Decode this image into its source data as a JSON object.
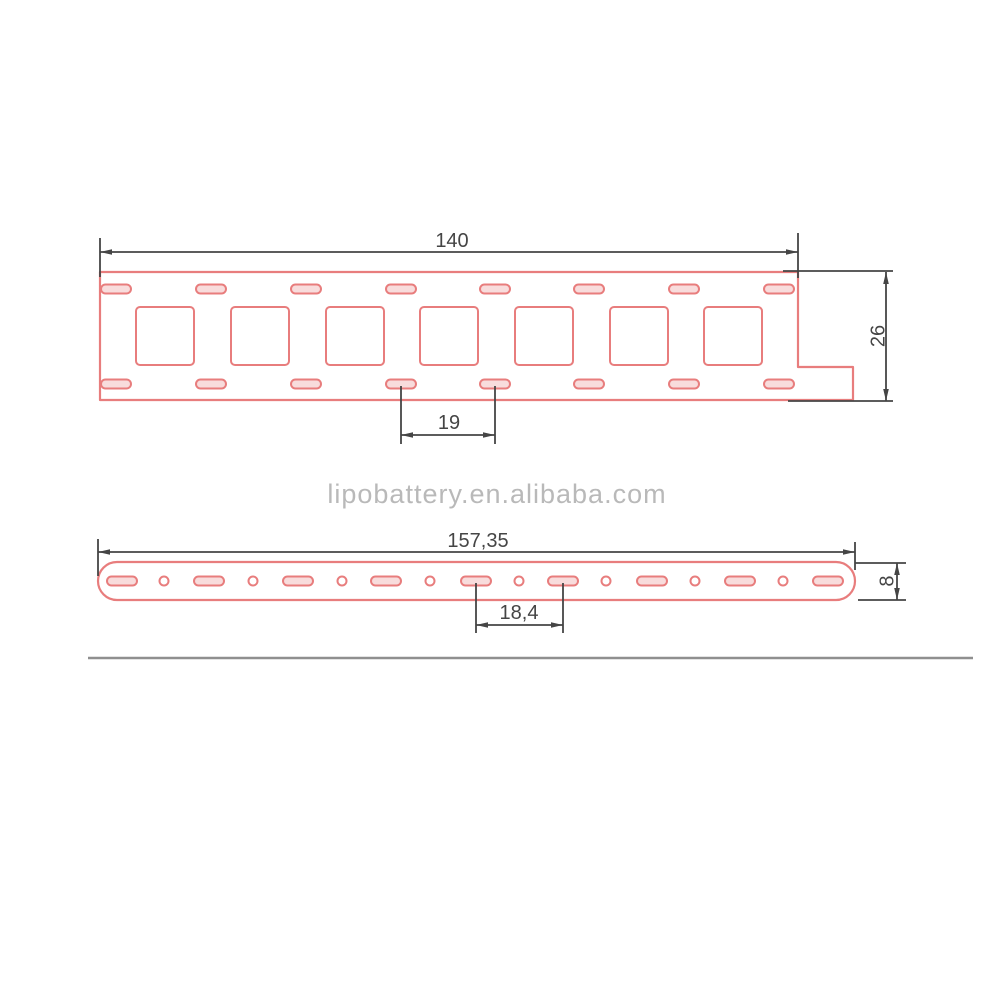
{
  "watermark": "lipobattery.en.alibaba.com",
  "top_view": {
    "width_label": "140",
    "height_label": "26",
    "pitch_label": "19",
    "squares": {
      "centers_x": [
        165,
        260,
        355,
        449,
        544,
        639,
        733
      ],
      "center_y": 336,
      "size": 58,
      "corner_radius": 4
    },
    "slots": {
      "centers_x": [
        116,
        211,
        306,
        401,
        495,
        589,
        684,
        779
      ],
      "rows_y": [
        289,
        384
      ],
      "width": 30,
      "height": 9
    }
  },
  "side_view": {
    "length_label": "157,35",
    "height_label": "8",
    "pitch_label": "18,4",
    "slots": {
      "centers_x": [
        122,
        209,
        298,
        386,
        476,
        563,
        652,
        740,
        828
      ],
      "center_y": 581,
      "width": 30,
      "height": 9
    },
    "holes": {
      "centers_x": [
        164,
        253,
        342,
        430,
        519,
        606,
        695,
        783
      ],
      "center_y": 581,
      "radius": 4.5
    }
  },
  "colors": {
    "background": "#ffffff",
    "outline": "#e87d7d",
    "slot_fill": "#f8dcdc",
    "dimension": "#454545",
    "watermark": "#b9b9b9",
    "separator": "#8f8f8f"
  }
}
